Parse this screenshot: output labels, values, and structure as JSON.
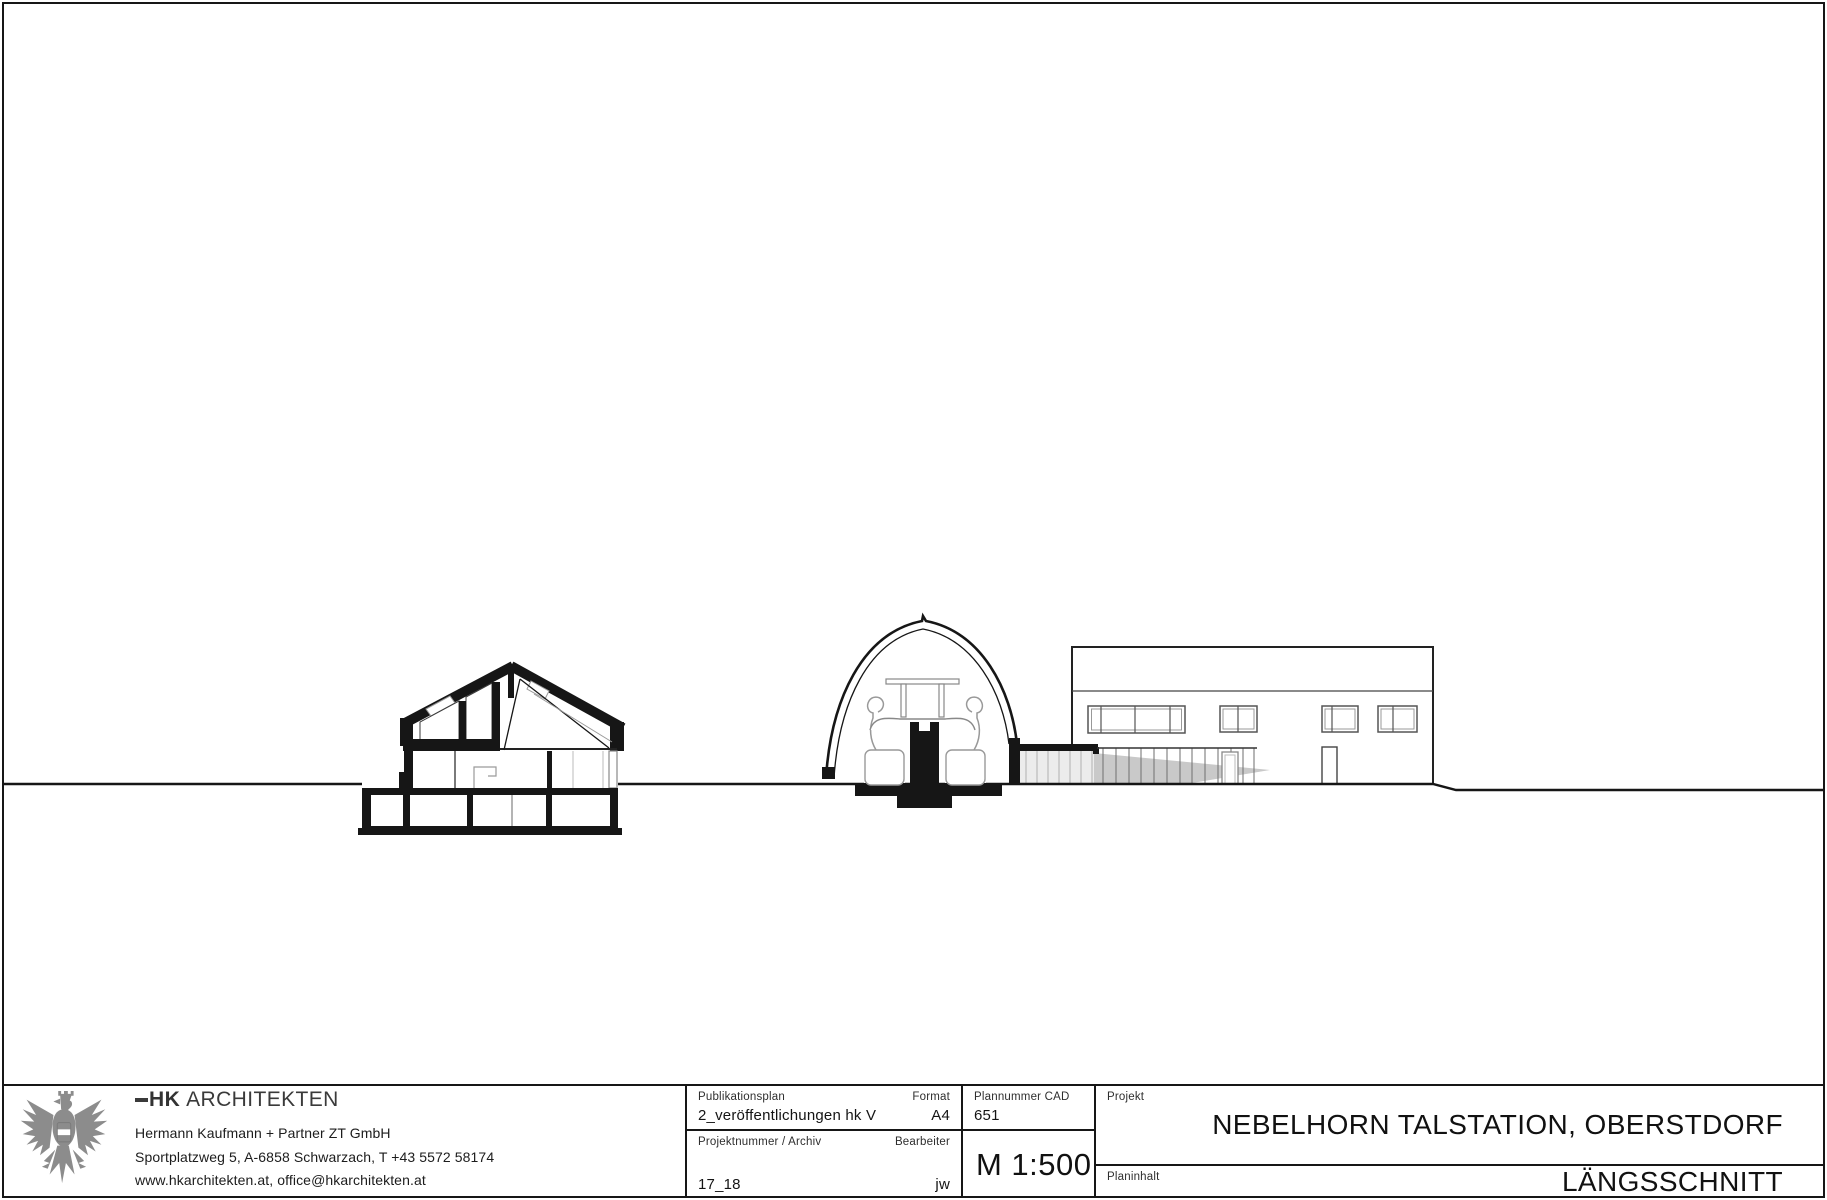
{
  "title_block": {
    "architect": {
      "emblem": "austrian-eagle",
      "logo_bold": "HK",
      "logo_rest": "ARCHITEKTEN",
      "line1": "Hermann Kaufmann + Partner ZT GmbH",
      "line2": "Sportplatzweg 5, A-6858 Schwarzach, T +43 5572 58174",
      "line3": "www.hkarchitekten.at, office@hkarchitekten.at"
    },
    "cells": {
      "publikationsplan": {
        "label": "Publikationsplan",
        "value": "2_veröffentlichungen hk V"
      },
      "format": {
        "label": "Format",
        "value": "A4"
      },
      "plannummer": {
        "label": "Plannummer CAD",
        "value": "651"
      },
      "projektnummer": {
        "label": "Projektnummer / Archiv",
        "value": "17_18"
      },
      "bearbeiter": {
        "label": "Bearbeiter",
        "value": "jw"
      },
      "massstab": {
        "value": "M 1:500"
      },
      "projekt": {
        "label": "Projekt",
        "value": "NEBELHORN TALSTATION, OBERSTDORF"
      },
      "planinhalt": {
        "label": "Planinhalt",
        "value": "LÄNGSSCHNITT"
      }
    }
  },
  "drawing": {
    "scale": "M 1:500",
    "content": "Longitudinal section: residential house section, cable-car station arch with two gondolas, covered walkway, station building elevation, continuous ground line",
    "colors": {
      "line": "#161616",
      "gray_line": "#999999",
      "shadow_fill": "#c9c9c9",
      "glass_fill": "#ececec",
      "eagle_gray": "#8c8c8c"
    }
  }
}
